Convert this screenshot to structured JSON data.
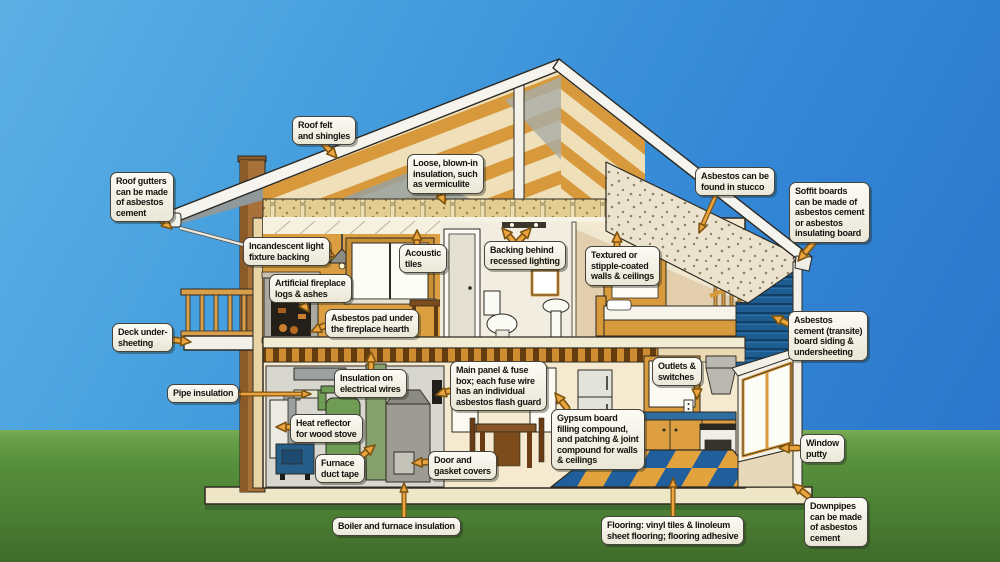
{
  "scene": {
    "description": "Cutaway diagram of a two-storey house showing locations of asbestos-containing materials",
    "colors": {
      "sky_top": "#5cb0e4",
      "sky_bottom": "#2a74ca",
      "grass": "#578f3c",
      "arrow_fill": "#eca43f",
      "arrow_stroke": "#7c5310",
      "label_bg": "#f4f2e6",
      "label_border": "#45433b",
      "label_text": "#16130f",
      "siding_blue": "#1e5d92",
      "checker_blue": "#205f9b",
      "checker_orange": "#e2a23e"
    }
  },
  "labels": [
    {
      "id": "roof-gutters",
      "x": 110,
      "y": 172,
      "lines": [
        "Roof gutters",
        "can be made",
        "of asbestos",
        "cement"
      ],
      "arrows": [
        [
          157,
          216,
          172,
          229
        ]
      ]
    },
    {
      "id": "deck-undersheeting",
      "x": 112,
      "y": 323,
      "lines": [
        "Deck under-",
        "sheeting"
      ],
      "arrows": [
        [
          174,
          340,
          191,
          342
        ]
      ]
    },
    {
      "id": "roof-felt",
      "x": 292,
      "y": 116,
      "lines": [
        "Roof felt",
        "and shingles"
      ],
      "arrows": [
        [
          324,
          144,
          337,
          158
        ]
      ]
    },
    {
      "id": "loose-insulation",
      "x": 407,
      "y": 154,
      "lines": [
        "Loose, blown-in",
        "insulation, such",
        "as vermiculite"
      ],
      "arrows": [
        [
          437,
          187,
          445,
          204
        ]
      ]
    },
    {
      "id": "incandescent-backing",
      "x": 243,
      "y": 237,
      "lines": [
        "Incandescent light",
        "fixture backing"
      ],
      "arrows": [
        [
          321,
          249,
          335,
          257
        ]
      ]
    },
    {
      "id": "acoustic-tiles",
      "x": 399,
      "y": 244,
      "lines": [
        "Acoustic",
        "tiles"
      ],
      "arrows": [
        [
          417,
          245,
          417,
          230
        ]
      ]
    },
    {
      "id": "backing-recessed-lighting",
      "x": 484,
      "y": 241,
      "lines": [
        "Backing behind",
        "recessed lighting"
      ],
      "arrows": [
        [
          514,
          242,
          502,
          228
        ],
        [
          518,
          242,
          531,
          228
        ]
      ]
    },
    {
      "id": "textured-walls",
      "x": 585,
      "y": 246,
      "lines": [
        "Textured or",
        "stipple-coated",
        "walls & ceilings"
      ],
      "arrows": [
        [
          617,
          247,
          617,
          232
        ]
      ]
    },
    {
      "id": "stucco",
      "x": 695,
      "y": 167,
      "lines": [
        "Asbestos can be",
        "found in stucco"
      ],
      "thin": true,
      "arrows": [
        [
          716,
          195,
          699,
          233
        ]
      ]
    },
    {
      "id": "soffit-boards",
      "x": 789,
      "y": 182,
      "lines": [
        "Soffit boards",
        "can be made of",
        "asbestos cement",
        "or asbestos",
        "insulating board"
      ],
      "arrows": [
        [
          814,
          242,
          798,
          261
        ]
      ]
    },
    {
      "id": "transite-siding",
      "x": 788,
      "y": 311,
      "lines": [
        "Asbestos",
        "cement (transite)",
        "board siding &",
        "undersheeting"
      ],
      "arrows": [
        [
          793,
          326,
          772,
          316
        ]
      ]
    },
    {
      "id": "window-putty",
      "x": 800,
      "y": 434,
      "lines": [
        "Window",
        "putty"
      ],
      "arrows": [
        [
          798,
          448,
          779,
          448
        ]
      ]
    },
    {
      "id": "downpipes",
      "x": 804,
      "y": 497,
      "lines": [
        "Downpipes",
        "can be made",
        "of asbestos",
        "cement"
      ],
      "arrows": [
        [
          808,
          496,
          793,
          484
        ]
      ]
    },
    {
      "id": "main-panel",
      "x": 450,
      "y": 361,
      "lines": [
        "Main panel & fuse",
        "box; each fuse wire",
        "has an individual",
        "asbestos flash guard"
      ],
      "arrows": [
        [
          449,
          391,
          436,
          395
        ]
      ]
    },
    {
      "id": "outlets-switches",
      "x": 652,
      "y": 357,
      "lines": [
        "Outlets &",
        "switches"
      ],
      "arrows": [
        [
          697,
          385,
          697,
          399
        ]
      ]
    },
    {
      "id": "gypsum-board",
      "x": 551,
      "y": 409,
      "lines": [
        "Gypsum board",
        "filling compound,",
        "and patching & joint",
        "compound for walls",
        "& ceilings"
      ],
      "arrows": [
        [
          567,
          408,
          555,
          393
        ]
      ]
    },
    {
      "id": "door-gasket",
      "x": 428,
      "y": 451,
      "lines": [
        "Door and",
        "gasket covers"
      ],
      "arrows": [
        [
          427,
          462,
          412,
          463
        ]
      ]
    },
    {
      "id": "furnace-duct-tape",
      "x": 315,
      "y": 454,
      "lines": [
        "Furnace",
        "duct tape"
      ],
      "arrows": [
        [
          362,
          456,
          375,
          445
        ]
      ]
    },
    {
      "id": "heat-reflector",
      "x": 290,
      "y": 414,
      "lines": [
        "Heat reflector",
        "for wood stove"
      ],
      "arrows": [
        [
          289,
          427,
          276,
          427
        ]
      ]
    },
    {
      "id": "pipe-insulation",
      "x": 167,
      "y": 384,
      "lines": [
        "Pipe insulation"
      ],
      "thin": true,
      "arrows": [
        [
          235,
          394,
          311,
          394
        ]
      ]
    },
    {
      "id": "insulation-wires",
      "x": 334,
      "y": 369,
      "lines": [
        "Insulation on",
        "electrical wires"
      ],
      "arrows": [
        [
          371,
          368,
          371,
          352
        ]
      ]
    },
    {
      "id": "boiler-furnace",
      "x": 332,
      "y": 517,
      "lines": [
        "Boiler and furnace insulation"
      ],
      "thin": true,
      "arrows": [
        [
          404,
          516,
          404,
          483
        ]
      ]
    },
    {
      "id": "flooring",
      "x": 601,
      "y": 516,
      "lines": [
        "Flooring: vinyl tiles & linoleum",
        "sheet flooring; flooring adhesive"
      ],
      "thin": true,
      "arrows": [
        [
          673,
          515,
          673,
          478
        ]
      ]
    },
    {
      "id": "fireplace-logs",
      "x": 269,
      "y": 274,
      "lines": [
        "Artificial fireplace",
        "logs & ashes"
      ],
      "arrows": [
        [
          299,
          298,
          309,
          312
        ]
      ]
    },
    {
      "id": "asbestos-pad",
      "x": 325,
      "y": 309,
      "lines": [
        "Asbestos pad under",
        "the fireplace hearth"
      ],
      "arrows": [
        [
          324,
          326,
          311,
          332
        ]
      ]
    }
  ]
}
